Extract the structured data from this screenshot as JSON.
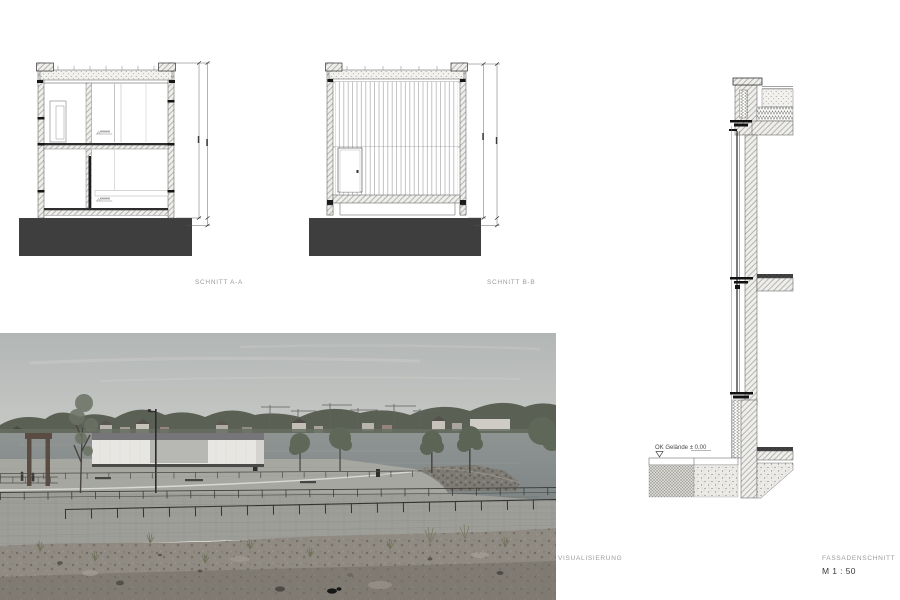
{
  "labels": {
    "section_a": "SCHNITT A-A",
    "section_b": "SCHNITT B-B",
    "visualization": "VISUALISIERUNG",
    "facade_section": "FASSADENSCHNITT",
    "scale": "M 1 : 50"
  },
  "facade": {
    "ground_level_label": "OK Gelände ± 0.00"
  },
  "colors": {
    "background": "#ffffff",
    "foundation": "#3e3e3e",
    "drawing_line": "#2f2f2f",
    "hatch_line": "#9a9a9a",
    "label_text": "#9b9b9b",
    "scale_text": "#3a3a3a"
  }
}
